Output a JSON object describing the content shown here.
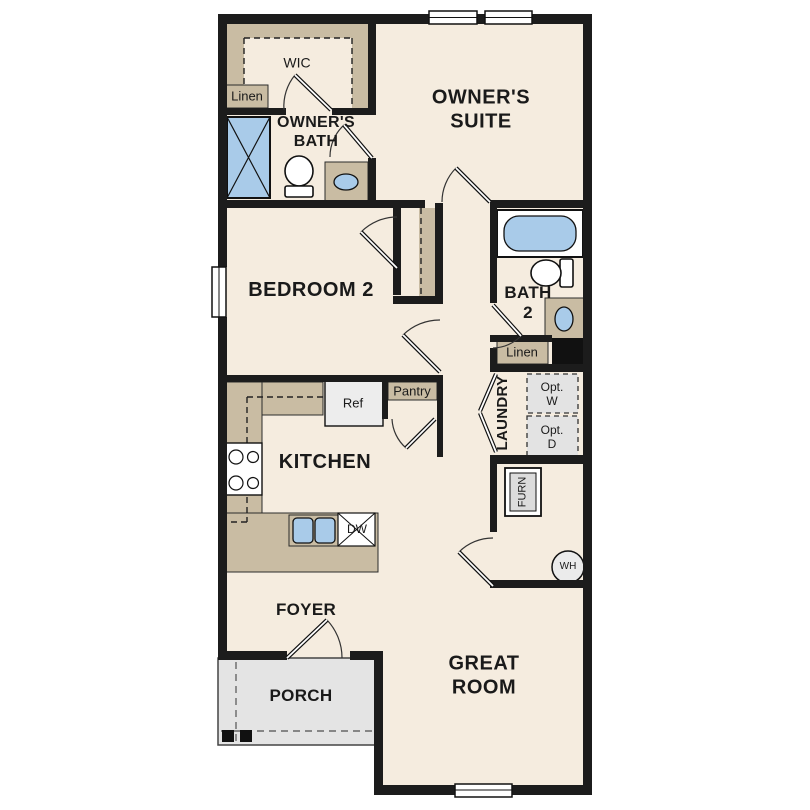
{
  "colors": {
    "wall": "#1c1c1c",
    "floor": "#f5ecdf",
    "cabinet": "#c9bca3",
    "porch": "#e4e4e4",
    "optbox": "#e3e3e3",
    "fixture_blue": "#a9cbe9",
    "appliance_gray": "#ededed",
    "line": "#2b2b2b"
  },
  "rooms": {
    "wic": "WIC",
    "owners_bath": [
      "OWNER'S",
      "BATH"
    ],
    "owners_suite": [
      "OWNER'S",
      "SUITE"
    ],
    "bedroom2": "BEDROOM 2",
    "bath2": [
      "BATH",
      "2"
    ],
    "laundry": "LAUNDRY",
    "kitchen": "KITCHEN",
    "foyer": "FOYER",
    "porch": "PORCH",
    "great_room": [
      "GREAT",
      "ROOM"
    ]
  },
  "features": {
    "linen_upper": "Linen",
    "linen_lower": "Linen",
    "pantry": "Pantry",
    "fridge": "Ref",
    "dishwasher": "DW",
    "opt_washer": [
      "Opt.",
      "W"
    ],
    "opt_dryer": [
      "Opt.",
      "D"
    ],
    "furnace": "FURN",
    "water_heater": "WH"
  }
}
